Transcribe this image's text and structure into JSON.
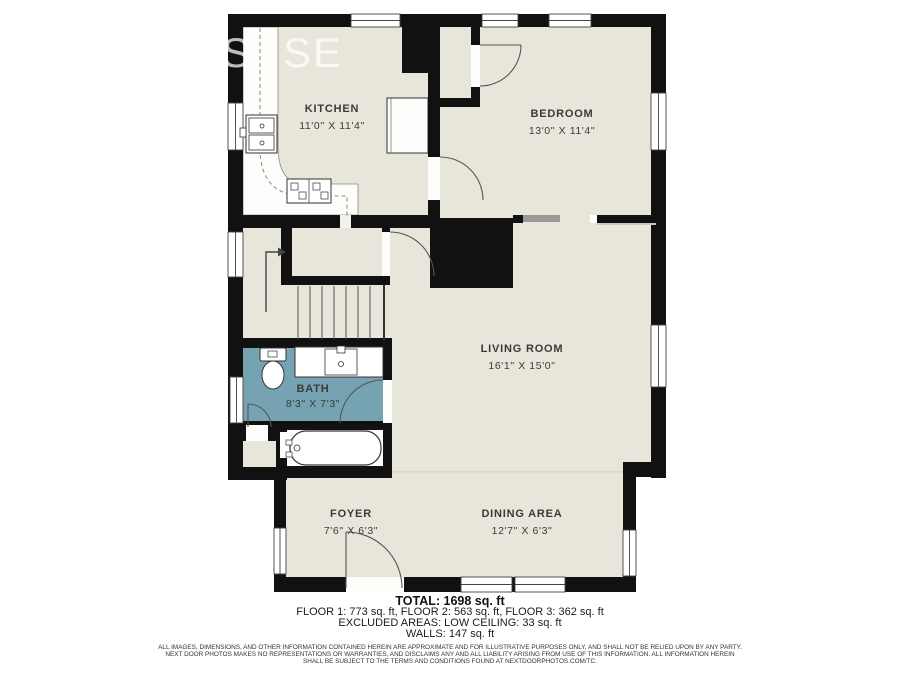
{
  "watermark": {
    "partial_letter": "S",
    "text": "SE"
  },
  "rooms": [
    {
      "id": "kitchen",
      "name": "KITCHEN",
      "dims": "11'0\" X 11'4\""
    },
    {
      "id": "bedroom",
      "name": "BEDROOM",
      "dims": "13'0\" X 11'4\""
    },
    {
      "id": "living",
      "name": "LIVING ROOM",
      "dims": "16'1\" X 15'0\""
    },
    {
      "id": "bath",
      "name": "BATH",
      "dims": "8'3\" X 7'3\""
    },
    {
      "id": "foyer",
      "name": "FOYER",
      "dims": "7'6\" X 6'3\""
    },
    {
      "id": "dining",
      "name": "DINING AREA",
      "dims": "12'7\" X 6'3\""
    }
  ],
  "summary": {
    "total": "TOTAL: 1698 sq. ft",
    "floors": "FLOOR 1: 773 sq. ft, FLOOR 2: 563 sq. ft, FLOOR 3: 362 sq. ft",
    "excluded": "EXCLUDED AREAS: LOW CEILING: 33 sq. ft",
    "walls": "WALLS: 147 sq. ft"
  },
  "disclaimer": {
    "lines": [
      "ALL IMAGES, DIMENSIONS, AND OTHER INFORMATION CONTAINED HEREIN ARE APPROXIMATE AND FOR ILLUSTRATIVE PURPOSES ONLY, AND SHALL NOT BE RELIED UPON BY ANY PARTY.",
      "NEXT DOOR PHOTOS MAKES NO REPRESENTATIONS OR WARRANTIES, AND DISCLAIMS ANY AND ALL LIABILITY ARISING FROM USE OF THIS INFORMATION. ALL INFORMATION HEREIN",
      "SHALL BE SUBJECT TO THE TERMS AND CONDITIONS FOUND AT NEXTDOORPHOTOS.COM/TC."
    ]
  },
  "colors": {
    "wall": "#111111",
    "floor": "#e8e6da",
    "bath_floor": "#76a3b2",
    "opening_bar": "#999999",
    "fixture_outline": "#333333",
    "label_text": "#3a3a3a"
  }
}
